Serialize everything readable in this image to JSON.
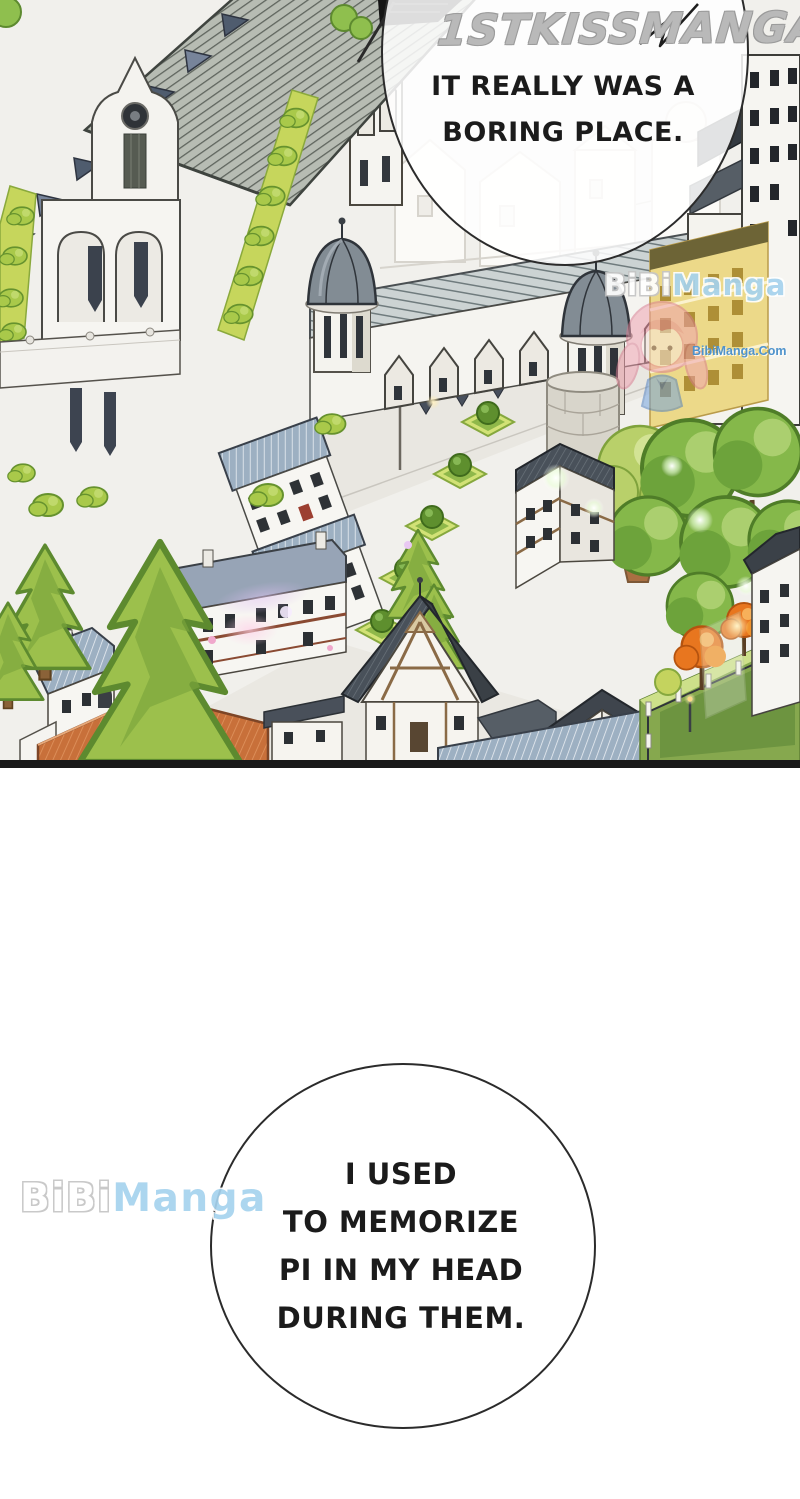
{
  "page": {
    "kind": "manga page"
  },
  "bubbles": {
    "top": {
      "lines": [
        "IT REALLY WAS A",
        "BORING PLACE."
      ]
    },
    "bottom": {
      "lines": [
        "I USED",
        "TO MEMORIZE",
        "PI IN MY HEAD",
        "DURING THEM."
      ]
    }
  },
  "watermarks": {
    "site_top": "1STKISSMANGA.ID",
    "logo_bibi": "BiBi",
    "logo_manga": "Manga",
    "site_small": "BibiManga.Com"
  },
  "colors": {
    "logo_blue": "#a6d3ee",
    "logo_outline": "#c5c5c5",
    "site_small_blue": "#4f93cc",
    "mascot_pink": "#efa0b0",
    "mascot_dress_blue": "#6ea0e0",
    "ink": "#2b2b2b",
    "panel_bg": "#f1f0ec",
    "roof_gray": "#828c94",
    "roof_blue_gray": "#97a4b6",
    "roof_dark": "#454c54",
    "hedge_green": "#c6d65c",
    "bush_green": "#a9c94a",
    "tree_green": "#85b84a",
    "big_tree_green": "#b9d06a",
    "autumn_orange": "#e8761f",
    "lawn_green": "#86a84e",
    "terracotta_roof": "#c8703a",
    "yellow_building": "#ecd989"
  }
}
